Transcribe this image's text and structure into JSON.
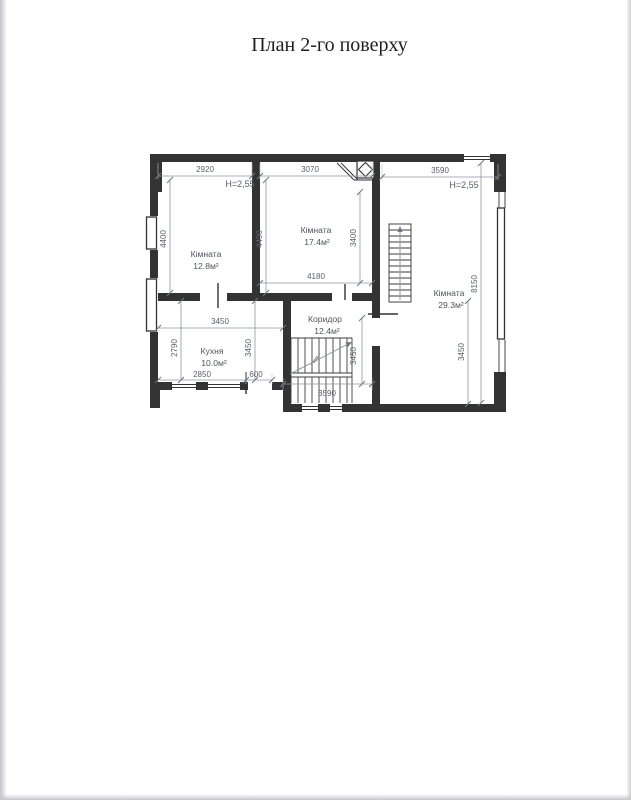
{
  "title": "План 2-го поверху",
  "plan": {
    "rooms": {
      "room1": {
        "name": "Кімната",
        "area": "12.8м²"
      },
      "room2": {
        "name": "Кімната",
        "area": "17.4м²"
      },
      "room3": {
        "name": "Кімната",
        "area": "29.3м²"
      },
      "kitchen": {
        "name": "Кухня",
        "area": "10.0м²"
      },
      "corridor": {
        "name": "Коридор",
        "area": "12.4м²"
      }
    },
    "heights": {
      "left": "H=2,55",
      "right": "H=2,55"
    },
    "dims": {
      "room1_top": "2920",
      "room2_top": "3070",
      "room3_top": "3590",
      "room1_height": "4400",
      "room2_height": "4400",
      "room2_inner_height": "3400",
      "room2_width_bottom": "4180",
      "room3_height": "8150",
      "kitchen_width_top": "3450",
      "kitchen_height": "2790",
      "kitchen_inner_height": "3450",
      "kitchen_width_bottom": "2850",
      "kitchen_door_width": "600",
      "stairs_height": "3450",
      "corridor_height": "3450",
      "stairs_width_bottom": "3590"
    }
  },
  "colors": {
    "background": "#ffffff",
    "wall": "#333333",
    "line_thin": "#8d96a0",
    "dim_text": "#5a616b",
    "room_text": "#4e545b",
    "title_text": "#1f1f1f",
    "photo_edge": "#c9c9ce"
  }
}
